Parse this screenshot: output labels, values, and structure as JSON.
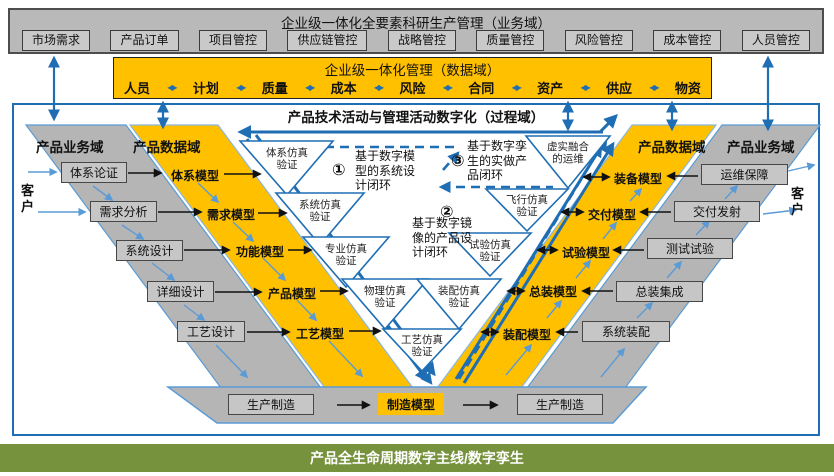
{
  "top_banner": {
    "title": "企业级一体化全要素科研生产管理（业务域）",
    "controls": [
      "市场需求",
      "产品订单",
      "项目管控",
      "供应链管控",
      "战略管控",
      "质量管控",
      "风险管控",
      "成本管控",
      "人员管控"
    ]
  },
  "data_banner": {
    "title": "企业级一体化管理（数据域）",
    "items": [
      "人员",
      "计划",
      "质量",
      "成本",
      "风险",
      "合同",
      "资产",
      "供应",
      "物资"
    ]
  },
  "process_domain": {
    "title": "产品技术活动与管理活动数字化（过程域）"
  },
  "left_business": {
    "header": "产品业务域",
    "customer": "客户",
    "items": [
      "体系论证",
      "需求分析",
      "系统设计",
      "详细设计",
      "工艺设计"
    ]
  },
  "left_data": {
    "header": "产品数据域",
    "items": [
      "体系模型",
      "需求模型",
      "功能模型",
      "产品模型",
      "工艺模型"
    ]
  },
  "right_data": {
    "header": "产品数据域",
    "items": [
      "装备模型",
      "交付模型",
      "试验模型",
      "总装模型",
      "装配模型"
    ]
  },
  "right_business": {
    "header": "产品业务域",
    "customer": "客户",
    "items": [
      "运维保障",
      "交付发射",
      "测试试验",
      "总装集成",
      "系统装配"
    ]
  },
  "v_core": {
    "triangles": [
      "体系仿真验证",
      "系统仿真验证",
      "专业仿真验证",
      "物理仿真验证",
      "装配仿真验证",
      "工艺仿真验证",
      "试验仿真验证",
      "飞行仿真验证",
      "虚实融合的运维"
    ],
    "loops": [
      {
        "num": "①",
        "text": "基于数字模型的系统设计闭环"
      },
      {
        "num": "②",
        "text": "基于数字镜像的产品设计闭环"
      },
      {
        "num": "③",
        "text": "基于数字孪生的实做产品闭环"
      }
    ]
  },
  "manufacturing": {
    "left": "生产制造",
    "model": "制造模型",
    "right": "生产制造"
  },
  "footer": {
    "title": "产品全生命周期数字主线/数字孪生"
  },
  "colors": {
    "accent_blue": "#1f6eb4",
    "light_blue": "#5b9bd5",
    "gold": "#ffc000",
    "gray_band": "#b5b5b5",
    "green": "#76923c"
  }
}
